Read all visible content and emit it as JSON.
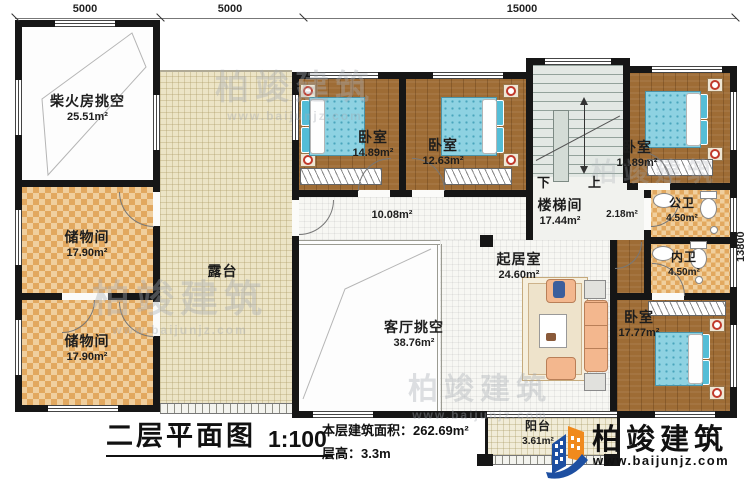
{
  "meta": {
    "title": "二层平面图",
    "scale": "1:100",
    "area_label": "本层建筑面积：",
    "area_value": "262.69m²",
    "height_label": "层高：",
    "height_value": "3.3m"
  },
  "brand": {
    "name": "柏竣建筑",
    "website": "www.baijunjz.com",
    "logo_blue": "#1d4fa1",
    "logo_orange": "#f08a1d"
  },
  "dimensions": {
    "top": [
      "5000",
      "5000",
      "15000"
    ],
    "right": "13800"
  },
  "stairs": {
    "down": "下",
    "up": "上"
  },
  "rooms": [
    {
      "name": "柴火房挑空",
      "area": "25.51m²"
    },
    {
      "name": "储物间",
      "area": "17.90m²"
    },
    {
      "name": "储物间",
      "area": "17.90m²"
    },
    {
      "name": "露台",
      "area": ""
    },
    {
      "name": "卧室",
      "area": "14.89m²"
    },
    {
      "name": "卧室",
      "area": "12.63m²"
    },
    {
      "name": "楼梯间",
      "area": "17.44m²"
    },
    {
      "name": "卧室",
      "area": "14.89m²"
    },
    {
      "name": "",
      "area": "10.08m²"
    },
    {
      "name": "",
      "area": "2.18m²"
    },
    {
      "name": "公卫",
      "area": "4.50m²"
    },
    {
      "name": "内卫",
      "area": "4.50m²"
    },
    {
      "name": "起居室",
      "area": "24.60m²"
    },
    {
      "name": "客厅挑空",
      "area": "38.76m²"
    },
    {
      "name": "卧室",
      "area": "17.77m²"
    },
    {
      "name": "阳台",
      "area": "3.61m²"
    }
  ]
}
